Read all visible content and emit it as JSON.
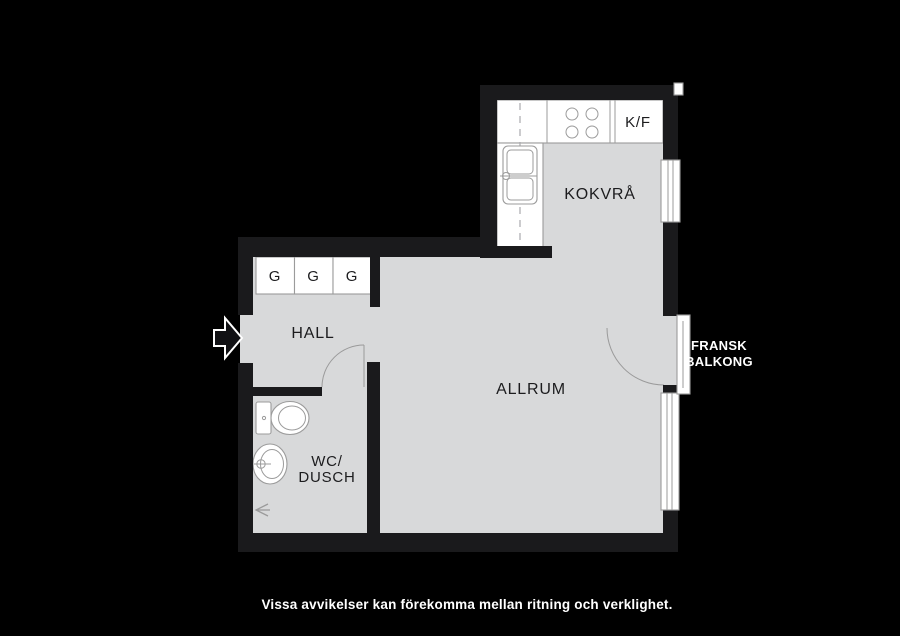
{
  "plan": {
    "colors": {
      "background": "#000000",
      "wall": "#1a1a1c",
      "floor": "#d8d9da",
      "fixture_stroke": "#9b9b9b",
      "room_label": "#1c1c1e",
      "outside_text": "#ffffff"
    },
    "labels": {
      "kokvra": "KOKVRÅ",
      "kf": "K/F",
      "hall": "HALL",
      "allrum": "ALLRUM",
      "wc_line1": "WC/",
      "wc_line2": "DUSCH"
    },
    "wardrobes": [
      "G",
      "G",
      "G"
    ],
    "balcony": {
      "line1": "FRANSK",
      "line2": "BALKONG"
    }
  },
  "footer": {
    "disclaimer": "Vissa avvikelser kan förekomma mellan ritning och verklighet."
  }
}
